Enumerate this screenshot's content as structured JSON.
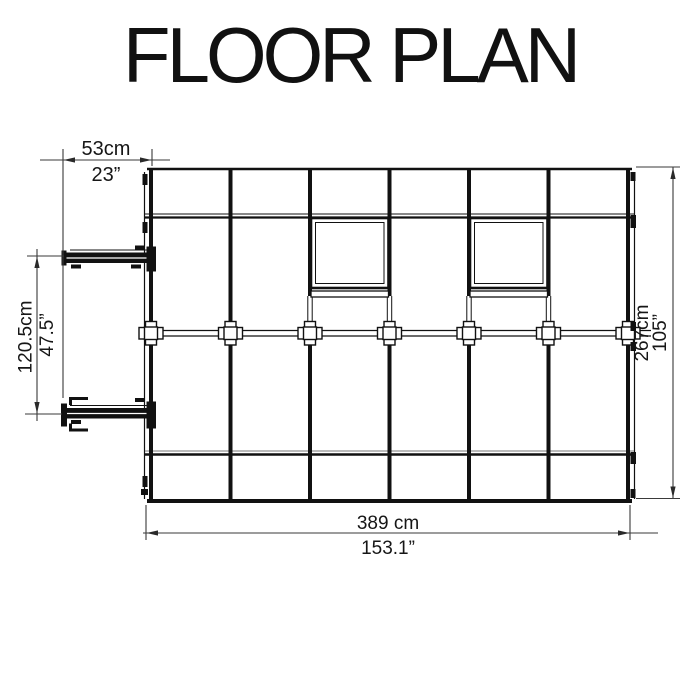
{
  "title": "FLOOR PLAN",
  "floor_plan": {
    "view": "top-down greenhouse frame plan",
    "bay_count": 6,
    "roof_vent_count": 2,
    "door_side": "left",
    "colors": {
      "line": "#111111",
      "dimension_line": "#3a3a3a",
      "background": "#ffffff"
    },
    "dimensions": {
      "top": {
        "metric": "53cm",
        "imperial": "23”"
      },
      "left": {
        "metric": "120.5cm",
        "imperial": "47.5”"
      },
      "right": {
        "metric": "267cm",
        "imperial": "105”"
      },
      "bottom": {
        "metric": "389 cm",
        "imperial": "153.1”"
      }
    }
  }
}
